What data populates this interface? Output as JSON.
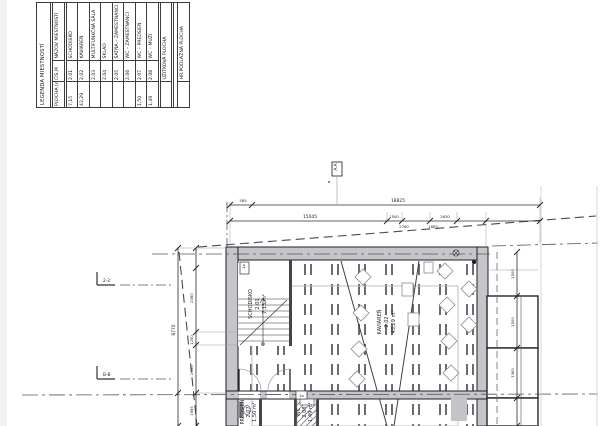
{
  "legend": {
    "title": "LEGENDA MIESTNOSTÍ",
    "headers": {
      "area": "PLOCHA [m²]",
      "number": "ČÍS.M",
      "name": "NÁZOV MIESTNOSTI"
    },
    "rooms": [
      {
        "number": "2.01",
        "name": "SCHODISKO",
        "area": "7,15"
      },
      {
        "number": "2.02",
        "name": "KAVIAREŇ",
        "area": "43,29"
      },
      {
        "number": "2.03",
        "name": "MULTIFUNKČNÁ SÁLA",
        "area": ""
      },
      {
        "number": "2.04",
        "name": "SKLAD",
        "area": ""
      },
      {
        "number": "2.05",
        "name": "ŠATŇA – ZAMESTNANCI",
        "area": ""
      },
      {
        "number": "2.06",
        "name": "WC – ZAMESTNANCI",
        "area": ""
      },
      {
        "number": "2.07",
        "name": "WC – PREDSIEŇ",
        "area": "1,50"
      },
      {
        "number": "2.08",
        "name": "WC – MUŽI",
        "area": "1,49"
      }
    ],
    "totals": [
      {
        "label": "ÚŽITKOVÁ PLOCHA",
        "area": ""
      },
      {
        "label": "HR.PODLAŽNÁ PLOCHA",
        "area": ""
      }
    ]
  },
  "plan": {
    "room_labels": {
      "schodisko": {
        "name": "SCHODISKO",
        "number": "2.01",
        "area": "7,15 m²"
      },
      "kaviaren": {
        "name": "KAVIAREŇ",
        "number": "2.02",
        "area": "43,29 m²"
      },
      "predsien": {
        "name": "PREDSIEŇ",
        "number": "2.07",
        "area": "1,50 m²"
      },
      "wc": {
        "name": "WC",
        "number": "2.08",
        "area": "1,49 m²"
      }
    },
    "markers": {
      "section_top": "A.A",
      "section_left_upper": "2-2",
      "section_left_lower": "B-B"
    },
    "wall_tags": {
      "tag1": "1a",
      "tag2": "2a"
    },
    "dimensions": {
      "top_overall": "18825",
      "top_left": "585",
      "mid_main": "15045",
      "mid_above_1": "1500",
      "mid_above_2": "2630",
      "mid_below_1": "2760",
      "mid_below_2": "1885",
      "left_outer": "8770",
      "left_1": "2080",
      "left_2": "1250",
      "left_3": "2430",
      "left_4": "1985",
      "right_1": "1500",
      "right_2": "1500",
      "right_3": "1365"
    }
  }
}
